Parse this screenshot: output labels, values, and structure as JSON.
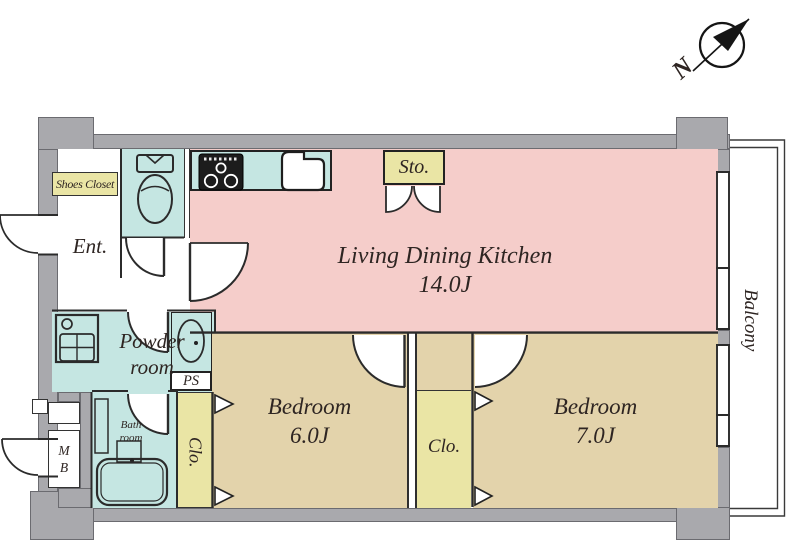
{
  "colors": {
    "ldk": "#f5cdca",
    "wet": "#c5e6e2",
    "closet": "#eae5a5",
    "bedroom": "#e3d3ab",
    "wall": "#a9a9ad",
    "line": "#2b2b2b",
    "text": "#2e2522"
  },
  "compass": {
    "north_label": "N"
  },
  "rooms": {
    "ldk": {
      "name": "Living Dining Kitchen",
      "size": "14.0J"
    },
    "bedroom_6j": {
      "name": "Bedroom",
      "size": "6.0J"
    },
    "bedroom_7j": {
      "name": "Bedroom",
      "size": "7.0J"
    },
    "entrance": {
      "label": "Ent."
    },
    "shoes_closet": {
      "label": "Shoes Closet"
    },
    "storage": {
      "label": "Sto."
    },
    "powder_room": {
      "line1": "Powder",
      "line2": "room"
    },
    "bath_room": {
      "line1": "Bath",
      "line2": "room"
    },
    "pipe_space": {
      "label": "PS"
    },
    "meter_box": {
      "line1": "M",
      "line2": "B"
    },
    "closet_bedroom_6j": {
      "label": "Clo."
    },
    "closet_bedroom_7j": {
      "label": "Clo."
    },
    "balcony": {
      "label": "Balcony"
    }
  }
}
